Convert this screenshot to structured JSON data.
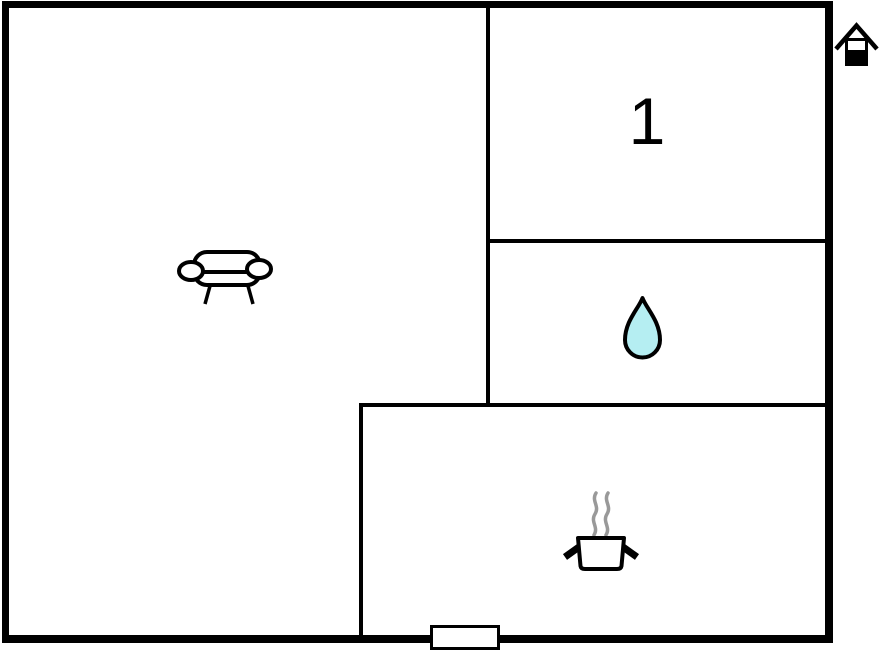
{
  "floor_plan": {
    "background_color": "#ffffff",
    "wall_color": "#000000",
    "rooms": [
      {
        "name": "living-room",
        "icon": "sofa-icon"
      },
      {
        "name": "bedroom",
        "label": "1"
      },
      {
        "name": "bathroom",
        "icon": "water-drop-icon",
        "icon_fill": "#b5eef2",
        "icon_stroke": "#000000"
      },
      {
        "name": "kitchen",
        "icon": "cooking-pot-icon",
        "steam_color": "#999999"
      }
    ],
    "markers": [
      {
        "name": "house-icon",
        "position": "top-right-outside"
      },
      {
        "name": "door-marker",
        "position": "bottom-wall-center"
      }
    ]
  }
}
